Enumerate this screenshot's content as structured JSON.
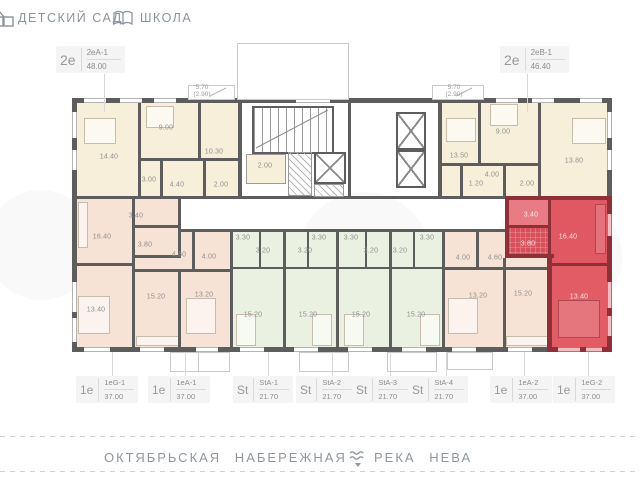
{
  "top_bar": {
    "kindergarten_label": "ДЕТСКИЙ САД",
    "school_label": "ШКОЛА"
  },
  "unit_labels_top": [
    {
      "type": "2е",
      "code": "2еА-1",
      "area": "48.00"
    },
    {
      "type": "2е",
      "code": "2еВ-1",
      "area": "46.40"
    }
  ],
  "unit_labels_bottom": [
    {
      "type": "1е",
      "code": "1еG-1",
      "area": "37.00"
    },
    {
      "type": "1е",
      "code": "1еА-1",
      "area": "37.00"
    },
    {
      "type": "St",
      "code": "StА-1",
      "area": "21.70"
    },
    {
      "type": "St",
      "code": "StА-2",
      "area": "21.70"
    },
    {
      "type": "St",
      "code": "StА-3",
      "area": "21.70"
    },
    {
      "type": "St",
      "code": "StА-4",
      "area": "21.70"
    },
    {
      "type": "1е",
      "code": "1еА-2",
      "area": "37.00"
    },
    {
      "type": "1е",
      "code": "1еG-2",
      "area": "37.00"
    }
  ],
  "plan": {
    "highlighted_unit": "1еG-2",
    "balcony_labels": [
      {
        "area": "5.70",
        "reduced": "(2.90)"
      },
      {
        "area": "5.70",
        "reduced": "(2.90)"
      }
    ],
    "room_labels": [
      {
        "label": "14.40",
        "x": 109,
        "y": 157,
        "theme": "gray"
      },
      {
        "label": "9.00",
        "x": 166,
        "y": 128,
        "theme": "gray"
      },
      {
        "label": "10.30",
        "x": 214,
        "y": 152,
        "theme": "gray"
      },
      {
        "label": "3.00",
        "x": 149,
        "y": 180,
        "theme": "gray"
      },
      {
        "label": "4.40",
        "x": 177,
        "y": 185,
        "theme": "gray"
      },
      {
        "label": "2.00",
        "x": 221,
        "y": 185,
        "theme": "gray"
      },
      {
        "label": "2.00",
        "x": 265,
        "y": 166,
        "theme": "gray"
      },
      {
        "label": "13.50",
        "x": 459,
        "y": 156,
        "theme": "gray"
      },
      {
        "label": "9.00",
        "x": 503,
        "y": 132,
        "theme": "gray"
      },
      {
        "label": "13.80",
        "x": 574,
        "y": 161,
        "theme": "gray"
      },
      {
        "label": "4.00",
        "x": 492,
        "y": 175,
        "theme": "gray"
      },
      {
        "label": "1.20",
        "x": 476,
        "y": 184,
        "theme": "gray"
      },
      {
        "label": "2.00",
        "x": 527,
        "y": 184,
        "theme": "gray"
      },
      {
        "label": "16.40",
        "x": 102,
        "y": 237,
        "theme": "gray"
      },
      {
        "label": "3.40",
        "x": 136,
        "y": 216,
        "theme": "gray"
      },
      {
        "label": "3.80",
        "x": 145,
        "y": 245,
        "theme": "gray"
      },
      {
        "label": "13.40",
        "x": 96,
        "y": 310,
        "theme": "gray"
      },
      {
        "label": "4.60",
        "x": 179,
        "y": 255,
        "theme": "gray"
      },
      {
        "label": "4.00",
        "x": 209,
        "y": 257,
        "theme": "gray"
      },
      {
        "label": "15.20",
        "x": 156,
        "y": 297,
        "theme": "gray"
      },
      {
        "label": "13.20",
        "x": 204,
        "y": 295,
        "theme": "gray"
      },
      {
        "label": "3.30",
        "x": 243,
        "y": 238,
        "theme": "gray"
      },
      {
        "label": "3.20",
        "x": 263,
        "y": 251,
        "theme": "gray"
      },
      {
        "label": "15.20",
        "x": 253,
        "y": 315,
        "theme": "gray"
      },
      {
        "label": "3.20",
        "x": 305,
        "y": 251,
        "theme": "gray"
      },
      {
        "label": "3.30",
        "x": 319,
        "y": 238,
        "theme": "gray"
      },
      {
        "label": "15.20",
        "x": 308,
        "y": 315,
        "theme": "gray"
      },
      {
        "label": "3.30",
        "x": 351,
        "y": 238,
        "theme": "gray"
      },
      {
        "label": "3.20",
        "x": 371,
        "y": 251,
        "theme": "gray"
      },
      {
        "label": "15.20",
        "x": 361,
        "y": 315,
        "theme": "gray"
      },
      {
        "label": "3.20",
        "x": 400,
        "y": 251,
        "theme": "gray"
      },
      {
        "label": "3.30",
        "x": 427,
        "y": 238,
        "theme": "gray"
      },
      {
        "label": "15.20",
        "x": 416,
        "y": 315,
        "theme": "gray"
      },
      {
        "label": "4.00",
        "x": 463,
        "y": 258,
        "theme": "gray"
      },
      {
        "label": "4.60",
        "x": 495,
        "y": 258,
        "theme": "gray"
      },
      {
        "label": "13.20",
        "x": 478,
        "y": 296,
        "theme": "gray"
      },
      {
        "label": "15.20",
        "x": 523,
        "y": 294,
        "theme": "gray"
      },
      {
        "label": "3.40",
        "x": 531,
        "y": 215,
        "theme": "red"
      },
      {
        "label": "3.80",
        "x": 528,
        "y": 244,
        "theme": "red"
      },
      {
        "label": "16.40",
        "x": 568,
        "y": 237,
        "theme": "red"
      },
      {
        "label": "13.40",
        "x": 579,
        "y": 297,
        "theme": "red"
      }
    ]
  },
  "footer": {
    "street_label": "ОКТЯБРЬСКАЯ НАБЕРЕЖНАЯ",
    "river_label": "РЕКА НЕВА"
  },
  "colors": {
    "highlight": "#e05862",
    "highlight_wall": "#8f3039",
    "cream": "#f8efdb",
    "salmon": "#f7e2d6",
    "green": "#eaf1e1",
    "wall": "#5d5d5d"
  }
}
